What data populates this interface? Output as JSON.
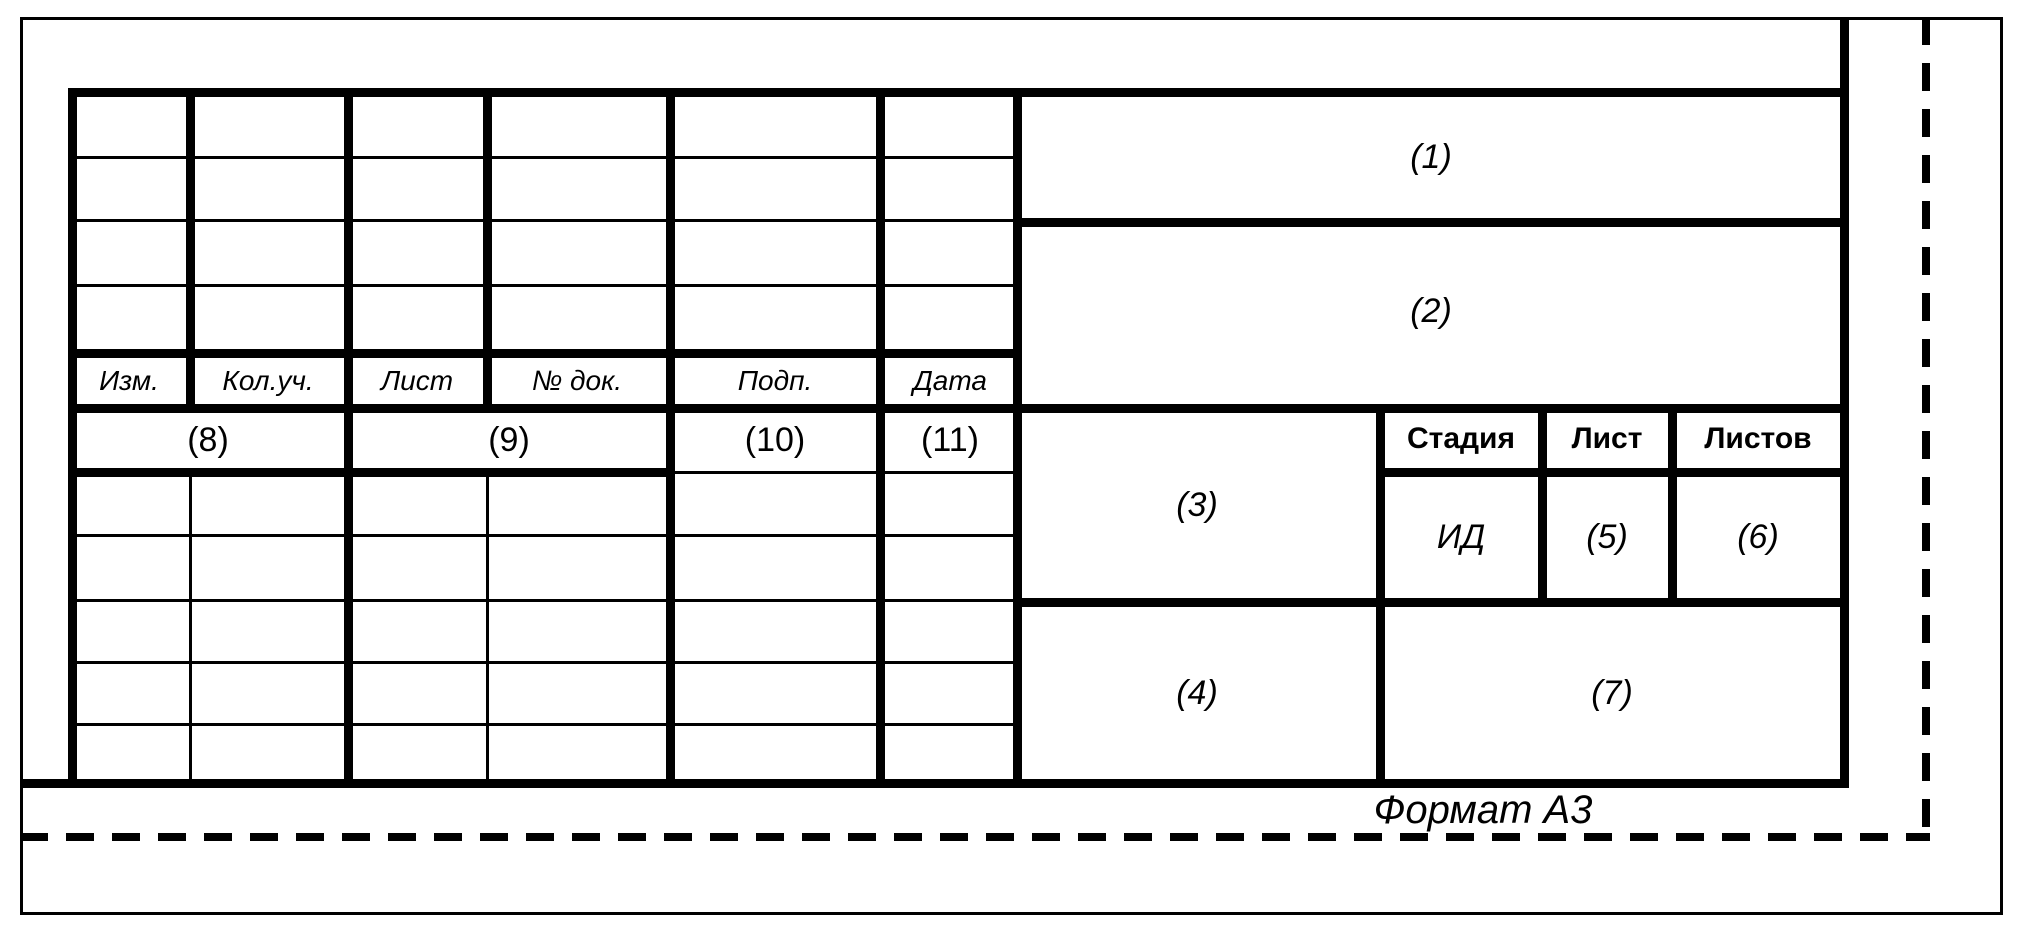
{
  "sheet": {
    "format_label": "Формат А3"
  },
  "revision_table": {
    "col_headers": [
      "Изм.",
      "Кол.уч.",
      "Лист",
      "№ док.",
      "Подп.",
      "Дата"
    ],
    "field_refs": [
      "(8)",
      "(9)",
      "(10)",
      "(11)"
    ]
  },
  "name_fields": {
    "f1": "(1)",
    "f2": "(2)",
    "f3": "(3)",
    "f4": "(4)",
    "f7": "(7)"
  },
  "stage_table": {
    "headers": [
      "Стадия",
      "Лист",
      "Листов"
    ],
    "stage": "ИД",
    "sheet_no": "(5)",
    "sheets_total": "(6)"
  },
  "colors": {
    "line": "#000000",
    "paper": "#ffffff"
  }
}
